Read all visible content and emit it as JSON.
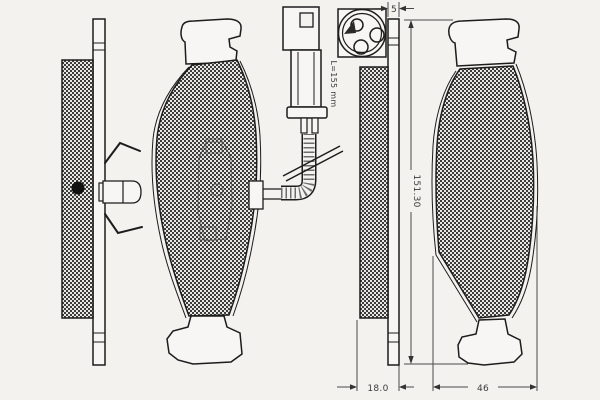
{
  "drawing": {
    "description": "brake pad set technical line drawing with wear sensor",
    "colors": {
      "background": "#f4f2ef",
      "line": "#1c1c1c",
      "dimension_line": "#4a4a4a",
      "friction_pattern_dark": "#3c3c3c",
      "friction_pattern_light": "#e9e7e4"
    },
    "dimensions": {
      "backplate_thickness_mm": "5",
      "pad_height_mm": "151.30",
      "pad_thickness_mm": "18.0",
      "bottom_width_mm": "46",
      "sensor_wire_length": "L=155 mm"
    }
  }
}
